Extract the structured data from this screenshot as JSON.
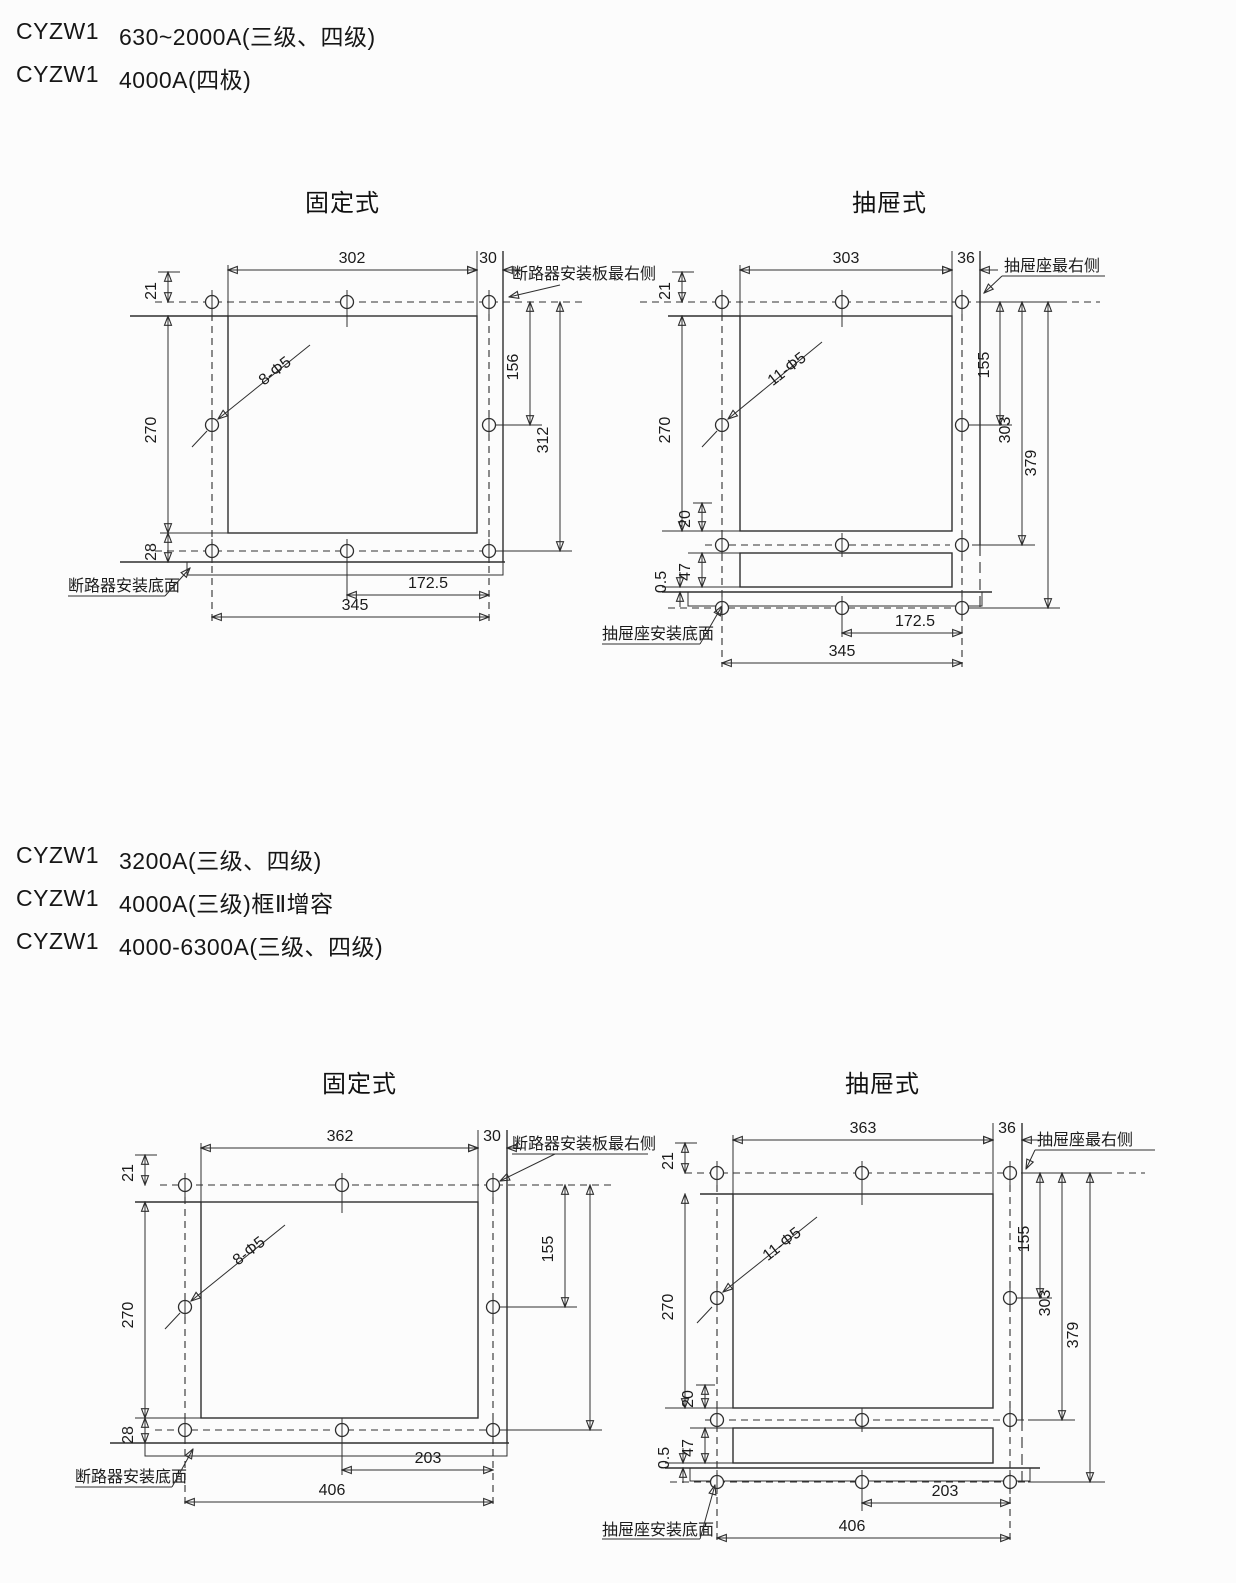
{
  "headers": {
    "top": [
      {
        "model": "CYZW1",
        "spec": "630~2000A(三级、四级)"
      },
      {
        "model": "CYZW1",
        "spec": "4000A(四极)"
      }
    ],
    "middle": [
      {
        "model": "CYZW1",
        "spec": "3200A(三级、四级)"
      },
      {
        "model": "CYZW1",
        "spec": "4000A(三级)框Ⅱ增容"
      },
      {
        "model": "CYZW1",
        "spec": "4000-6300A(三级、四级)"
      }
    ]
  },
  "sections": [
    {
      "fixed_title": "固定式",
      "drawer_title": "抽屉式"
    },
    {
      "fixed_title": "固定式",
      "drawer_title": "抽屉式"
    }
  ],
  "diagrams": {
    "fixed1": {
      "dims": {
        "width": "302",
        "edge": "30",
        "top": "21",
        "height": "270",
        "bottom": "28",
        "mid": "156",
        "span": "312",
        "half": "172.5",
        "total": "345"
      },
      "holes": "8-Φ5",
      "edge_label": "断路器安装板最右侧",
      "base_label": "断路器安装底面"
    },
    "drawer1": {
      "dims": {
        "width": "303",
        "edge": "36",
        "top": "21",
        "height": "270",
        "gap": "20",
        "offset": "0.5",
        "seat": "47",
        "mid": "155",
        "span": "303",
        "full": "379",
        "half": "172.5",
        "total": "345"
      },
      "holes": "11-Φ5",
      "edge_label": "抽屉座最右侧",
      "base_label": "抽屉座安装底面"
    },
    "fixed2": {
      "dims": {
        "width": "362",
        "edge": "30",
        "top": "21",
        "height": "270",
        "bottom": "28",
        "mid": "155",
        "half": "203",
        "total": "406"
      },
      "holes": "8-Φ5",
      "edge_label": "断路器安装板最右侧",
      "base_label": "断路器安装底面"
    },
    "drawer2": {
      "dims": {
        "width": "363",
        "edge": "36",
        "top": "21",
        "height": "270",
        "gap": "20",
        "offset": "0.5",
        "seat": "47",
        "mid": "155",
        "span": "303",
        "full": "379",
        "half": "203",
        "total": "406"
      },
      "holes": "11-Φ5",
      "edge_label": "抽屉座最右侧",
      "base_label": "抽屉座安装底面"
    }
  }
}
